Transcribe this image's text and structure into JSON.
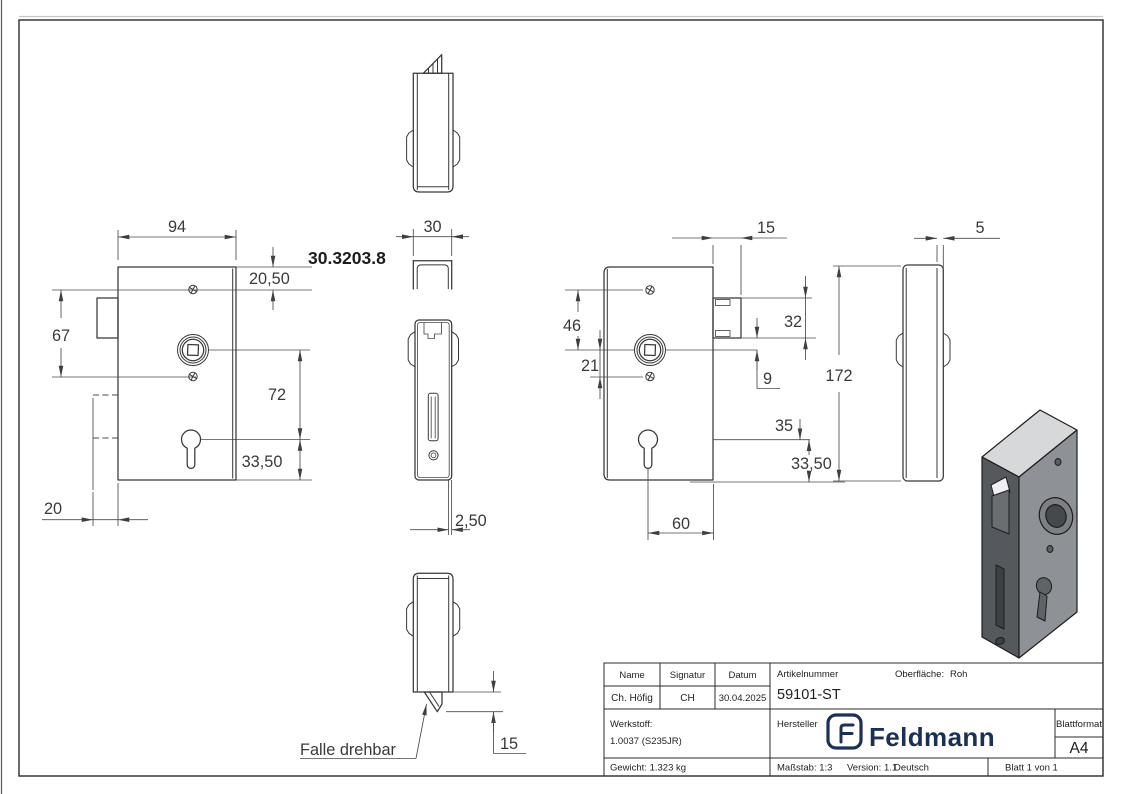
{
  "part_number": "30.3203.8",
  "annotations": {
    "falle_drehbar": "Falle drehbar"
  },
  "dims": {
    "body_width": "94",
    "top_to_screw": "20,50",
    "screw_spacing": "67",
    "spindle_to_cylinder": "72",
    "cylinder_to_bottom": "33,50",
    "box_depth": "20",
    "profile_width": "30",
    "faceplate_thickness_front": "2,50",
    "latch_protrusion_bottom": "15",
    "latch_protrusion_side": "15",
    "screw_to_spindle": "46",
    "spindle_to_screw": "21",
    "latch_height": "32",
    "latch_offset": "9",
    "cylinder_line": "35",
    "cylinder_to_bottom_right": "33,50",
    "cylinder_offset": "60",
    "body_height": "172",
    "faceplate_thickness_side": "5"
  },
  "title_block": {
    "name_label": "Name",
    "signatur_label": "Signatur",
    "datum_label": "Datum",
    "name_value": "Ch. Höfig",
    "signatur_value": "CH",
    "datum_value": "30.04.2025",
    "artikelnummer_label": "Artikelnummer",
    "artikelnummer_value": "59101-ST",
    "oberflaeche_label": "Oberfläche:",
    "oberflaeche_value": "Roh",
    "werkstoff_label": "Werkstoff:",
    "werkstoff_value": "1.0037 (S235JR)",
    "hersteller_label": "Hersteller",
    "brand_name": "Feldmann",
    "blattformat_label": "Blattformat",
    "blattformat_value": "A4",
    "gewicht": "Gewicht: 1.323 kg",
    "massstab": "Maßstab: 1:3",
    "version": "Version: 1.1",
    "sprache": "Deutsch",
    "blatt": "Blatt 1 von 1"
  }
}
